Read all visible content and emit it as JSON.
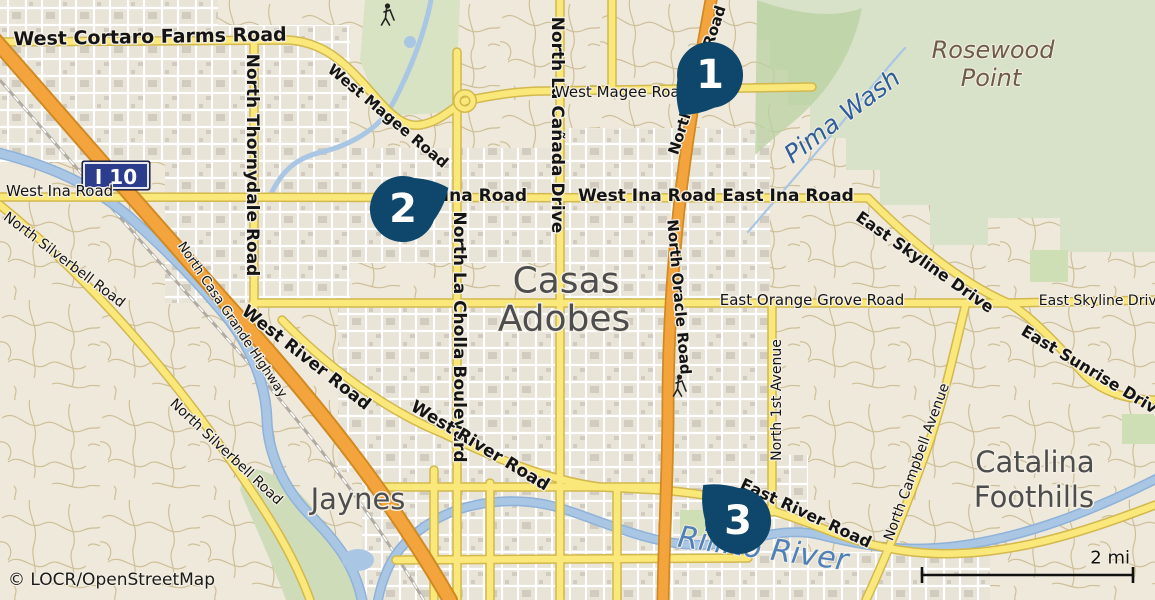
{
  "map": {
    "attribution": "© LOCR/OpenStreetMap",
    "scale_label": "2 mi",
    "shield_label": "I 10",
    "marker_color": "#0e476b",
    "markers": [
      {
        "id": "marker-1",
        "number": "1",
        "x": 710,
        "y": 75,
        "rot": 37
      },
      {
        "id": "marker-2",
        "number": "2",
        "x": 403,
        "y": 209,
        "rot": 245
      },
      {
        "id": "marker-3",
        "number": "3",
        "x": 738,
        "y": 521,
        "rot": 136
      }
    ],
    "labels": [
      {
        "name": "road-west-cortaro-farms-road",
        "text": "West Cortaro Farms Road",
        "x": 150,
        "y": 37,
        "rot": -1,
        "cls": "rb19"
      },
      {
        "name": "road-west-magee-road-diagonal",
        "text": "West Magee Road",
        "x": 388,
        "y": 116,
        "rot": 40,
        "cls": "rb15"
      },
      {
        "name": "road-north-thornydale-road",
        "text": "North Thornydale Road",
        "x": 252,
        "y": 165,
        "rot": 90,
        "cls": "rb17"
      },
      {
        "name": "road-north-la-canada-drive",
        "text": "North La Cañada Drive",
        "x": 557,
        "y": 125,
        "rot": 90,
        "cls": "rb17"
      },
      {
        "name": "road-west-magee-road",
        "text": "West Magee Road",
        "x": 622,
        "y": 92,
        "rot": 0,
        "cls": "rn15"
      },
      {
        "name": "road-north-oracle-road-upper",
        "text": "North Oracle Road",
        "x": 697,
        "y": 80,
        "rot": -72,
        "cls": "rb15"
      },
      {
        "name": "road-north-oracle-road-lower",
        "text": "North Oracle Road",
        "x": 679,
        "y": 297,
        "rot": 85,
        "cls": "rb15"
      },
      {
        "name": "water-pima-wash",
        "text": "Pima Wash",
        "x": 842,
        "y": 116,
        "rot": -37,
        "cls": "wlab25"
      },
      {
        "name": "place-rosewood-point-line1",
        "text": "Rosewood",
        "x": 993,
        "y": 50,
        "rot": 0,
        "cls": "plab24i"
      },
      {
        "name": "place-rosewood-point-line2",
        "text": "Point",
        "x": 991,
        "y": 78,
        "rot": 0,
        "cls": "plab24i"
      },
      {
        "name": "road-west-ina-road-left",
        "text": "West Ina Road",
        "x": 6,
        "y": 191,
        "rot": 0,
        "cls": "rn15",
        "anchor": "start"
      },
      {
        "name": "road-west-ina-road-marker",
        "text": "West Ina Road",
        "x": 458,
        "y": 196,
        "rot": 0,
        "cls": "rb17"
      },
      {
        "name": "road-west-ina-road-center",
        "text": "West Ina Road",
        "x": 647,
        "y": 196,
        "rot": 0,
        "cls": "rb17"
      },
      {
        "name": "road-east-ina-road",
        "text": "East Ina Road",
        "x": 788,
        "y": 196,
        "rot": 0,
        "cls": "rb17"
      },
      {
        "name": "road-east-skyline-drive-diag",
        "text": "East Skyline Drive",
        "x": 925,
        "y": 262,
        "rot": 35,
        "cls": "rb16"
      },
      {
        "name": "road-east-skyline-drive-right",
        "text": "East Skyline Drive",
        "x": 1102,
        "y": 301,
        "rot": 0,
        "cls": "rn14"
      },
      {
        "name": "road-east-orange-grove-road",
        "text": "East Orange Grove Road",
        "x": 812,
        "y": 300,
        "rot": 0,
        "cls": "rn15"
      },
      {
        "name": "place-casas-adobes-line1",
        "text": "Casas",
        "x": 566,
        "y": 281,
        "rot": 0,
        "cls": "plab36"
      },
      {
        "name": "place-casas-adobes-line2",
        "text": "Adobes",
        "x": 564,
        "y": 319,
        "rot": 0,
        "cls": "plab36"
      },
      {
        "name": "road-north-la-cholla-boulevard",
        "text": "North La Cholla Boulevard",
        "x": 459,
        "y": 337,
        "rot": 90,
        "cls": "rb17"
      },
      {
        "name": "road-north-1st-avenue",
        "text": "North 1st Avenue",
        "x": 777,
        "y": 400,
        "rot": -90,
        "cls": "rn14"
      },
      {
        "name": "road-west-river-road-1",
        "text": "West River Road",
        "x": 306,
        "y": 358,
        "rot": 38,
        "cls": "rb17"
      },
      {
        "name": "road-west-river-road-2",
        "text": "West River Road",
        "x": 480,
        "y": 446,
        "rot": 31,
        "cls": "rb17"
      },
      {
        "name": "road-north-casa-grande-highway",
        "text": "North Casa Grande Highway",
        "x": 232,
        "y": 320,
        "rot": 56,
        "cls": "rn13"
      },
      {
        "name": "road-north-silverbell-road-1",
        "text": "North Silverbell Road",
        "x": 64,
        "y": 260,
        "rot": 37,
        "cls": "rn14"
      },
      {
        "name": "road-north-silverbell-road-2",
        "text": "North Silverbell Road",
        "x": 226,
        "y": 452,
        "rot": 43,
        "cls": "rn14"
      },
      {
        "name": "place-jaynes",
        "text": "Jaynes",
        "x": 358,
        "y": 499,
        "rot": 0,
        "cls": "plab29"
      },
      {
        "name": "road-east-river-road",
        "text": "East River Road",
        "x": 806,
        "y": 513,
        "rot": 25,
        "cls": "rb16"
      },
      {
        "name": "water-rillito-river",
        "text": "Rillito River",
        "x": 763,
        "y": 549,
        "rot": 8,
        "cls": "wlab30"
      },
      {
        "name": "road-north-campbell-avenue",
        "text": "North Campbell Avenue",
        "x": 917,
        "y": 462,
        "rot": -70,
        "cls": "rn14"
      },
      {
        "name": "road-east-sunrise-drive",
        "text": "East Sunrise Drive",
        "x": 1094,
        "y": 372,
        "rot": 31,
        "cls": "rb16"
      },
      {
        "name": "place-catalina-foothills-line1",
        "text": "Catalina",
        "x": 1035,
        "y": 462,
        "rot": 0,
        "cls": "plab29"
      },
      {
        "name": "place-catalina-foothills-line2",
        "text": "Foothills",
        "x": 1034,
        "y": 497,
        "rot": 0,
        "cls": "plab29"
      },
      {
        "name": "map-attribution",
        "text": "© LOCR/OpenStreetMap",
        "x": 8,
        "y": 580,
        "rot": 0,
        "cls": "attr17",
        "anchor": "start"
      },
      {
        "name": "scale-bar-label",
        "text": "2 mi",
        "x": 1130,
        "y": 558,
        "rot": 0,
        "cls": "scale17",
        "anchor": "end"
      }
    ]
  }
}
